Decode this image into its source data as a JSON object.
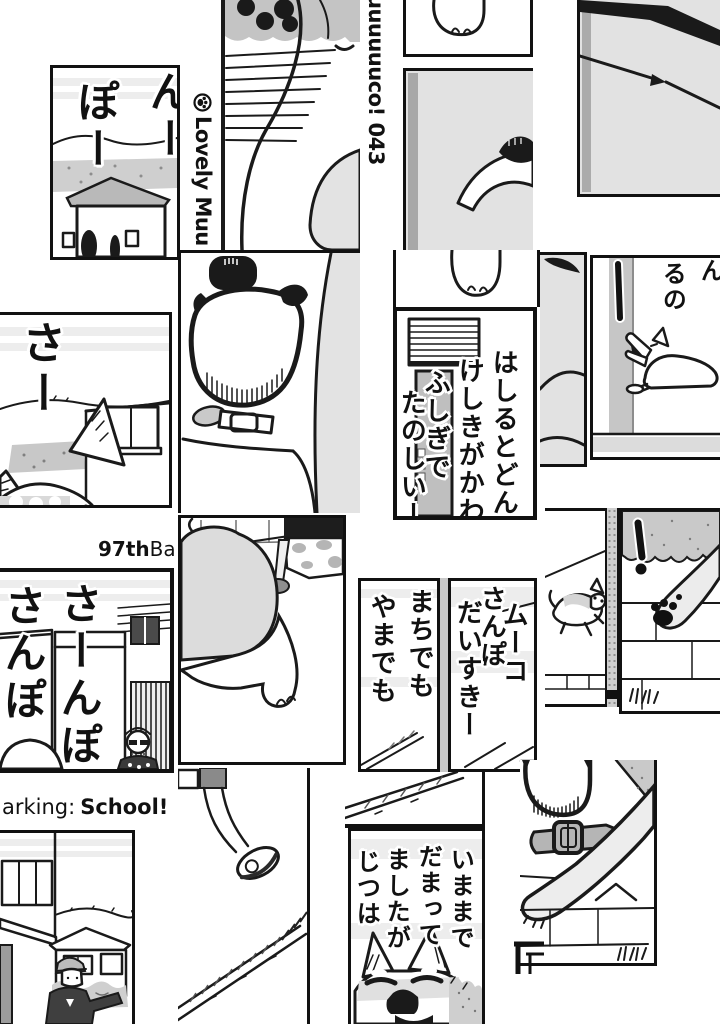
{
  "palette": {
    "ink": "#1a1a1a",
    "paper": "#ffffff",
    "gray_light": "#e3e3e3",
    "gray_mid": "#c9c9c9",
    "gray_dark": "#9a9a9a"
  },
  "header": {
    "series_logo_icon": "paw-circle-icon",
    "series_logo_text": "Lovely Muu",
    "series_continuation_text": "uuuuuuco! 043"
  },
  "chapter": {
    "number_bold": "97th",
    "title_fragment_after_number": "Ba",
    "title_fragment_regular": "arking:",
    "title_fragment_bold": "School!"
  },
  "sfx": {
    "pon_col_right": "んー",
    "pon_col_left": "ぽー",
    "saa": "さー",
    "sanpo_col_right": "さーんぽ",
    "sanpo_col_left": "さんぽ"
  },
  "dialogue": {
    "hashiru_cols": [
      "はしるとどん",
      "けしきがかわ",
      "ふしぎで",
      "たのしいー"
    ],
    "yawn_col_right": "ん",
    "yawn_col_left": "るの",
    "machi_cols": [
      "まちでも",
      "やまでも"
    ],
    "muco_cols": [
      "ムーコ",
      "さんぽ",
      "だいすきー"
    ],
    "imamade_cols": [
      "いままで",
      "だまって",
      "ましたが",
      "じつは"
    ]
  }
}
